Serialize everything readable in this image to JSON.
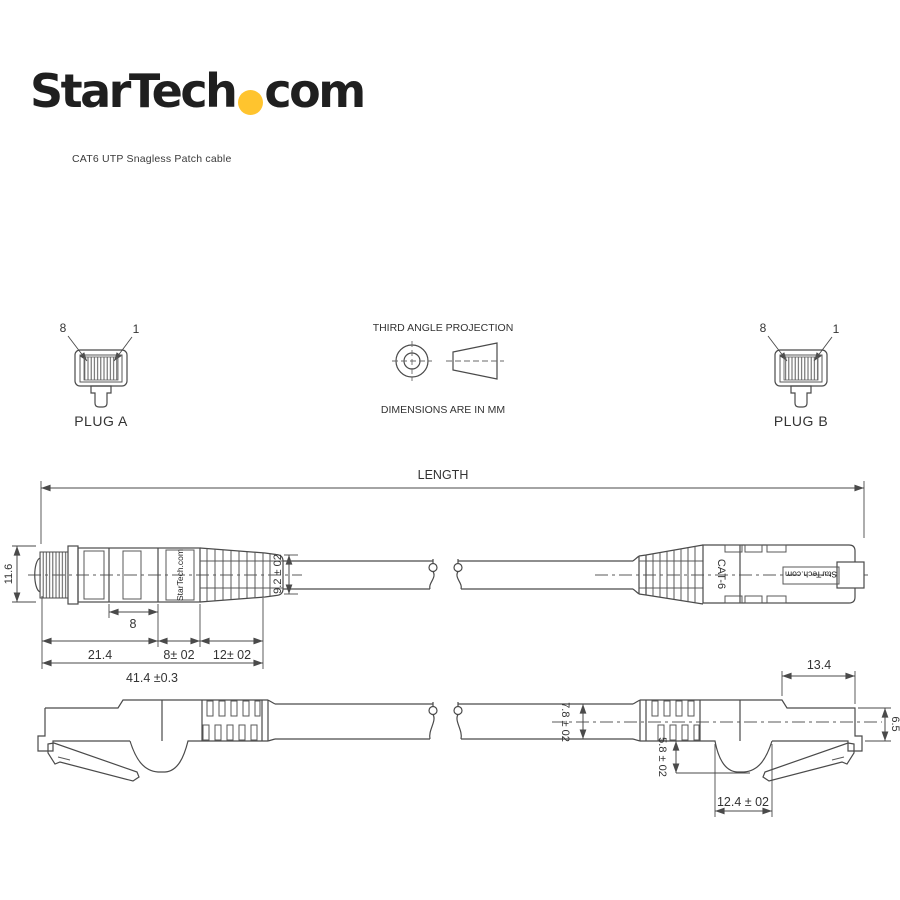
{
  "colors": {
    "line": "#4a4a4a",
    "text": "#333333",
    "logo": "#1f1f1f",
    "accent_yellow": "#ffc42e",
    "background": "#ffffff"
  },
  "header": {
    "logo_part1": "StarTech",
    "logo_part2": "com",
    "subtitle": "CAT6 UTP Snagless Patch cable"
  },
  "projection": {
    "title": "THIRD ANGLE PROJECTION",
    "note": "DIMENSIONS ARE IN MM"
  },
  "plug_a": {
    "name": "PLUG A",
    "pin_left": "8",
    "pin_right": "1"
  },
  "plug_b": {
    "name": "PLUG B",
    "pin_left": "8",
    "pin_right": "1"
  },
  "length_dim": {
    "label": "LENGTH"
  },
  "top_view": {
    "brand_left": "StarTech.com",
    "brand_right": "StarTech.com",
    "cable_marking": "CAT-6",
    "dims": {
      "height": "11.6",
      "window": "8",
      "plug_len": "21.4",
      "mid_len": "8± 02",
      "boot_len": "12± 02",
      "overall": "41.4 ±0.3",
      "boot_od": "9.2 ± 02"
    }
  },
  "side_view": {
    "dims": {
      "cable_od": "7.8 ± 02",
      "plug_top_len": "13.4",
      "plug_height": "6.5",
      "bump_depth": "5.8 ± 02",
      "bump_len": "12.4 ± 02"
    }
  }
}
